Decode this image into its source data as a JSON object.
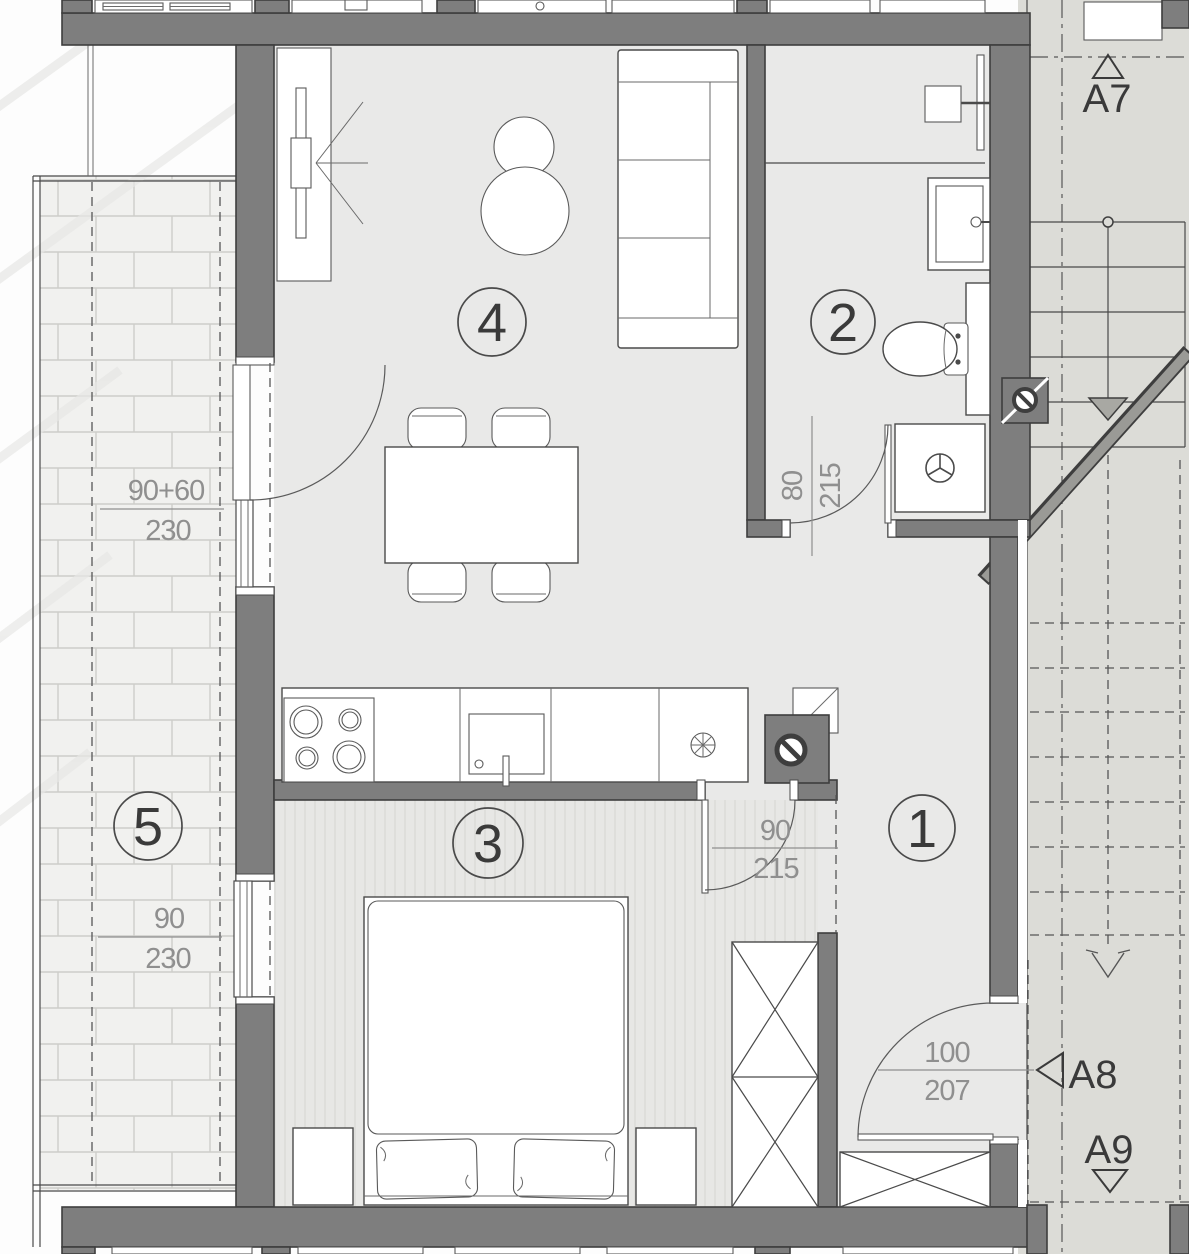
{
  "page": {
    "title": "Apartment floor plan with stairwell"
  },
  "rooms": [
    {
      "number": "1",
      "name": "hall"
    },
    {
      "number": "2",
      "name": "bathroom"
    },
    {
      "number": "3",
      "name": "bedroom"
    },
    {
      "number": "4",
      "name": "living-dining"
    },
    {
      "number": "5",
      "name": "balcony"
    }
  ],
  "dimensions": {
    "balcony_door": {
      "width": "90+60",
      "height": "230"
    },
    "balcony_window": {
      "width": "90",
      "height": "230"
    },
    "bathroom_door": {
      "width": "80",
      "height": "215"
    },
    "bedroom_door": {
      "width": "90",
      "height": "215"
    },
    "entry_door": {
      "width": "100",
      "height": "207"
    }
  },
  "stair_labels": {
    "a7": "A7",
    "a8": "A8",
    "a9": "A9"
  },
  "icons": [
    "stove-icon",
    "sink-icon",
    "extractor-fan-icon",
    "vent-shaft-icon",
    "shower-icon",
    "washbasin-icon",
    "toilet-icon",
    "washing-machine-icon",
    "sofa-icon",
    "tv-icon",
    "plant-icon",
    "dining-table-icon",
    "bed-icon",
    "wardrobe-icon",
    "stair-arrow-icon"
  ],
  "colors": {
    "wall": "#7e7e7e",
    "wall_outline": "#3e3e3e",
    "floor": "#e9e9e8",
    "balcony_floor": "#f1f1ef",
    "stair_floor": "#dcdcd7",
    "bedroom_floor": "#e7e7e5",
    "dim_text": "#8f8f8f",
    "label_text": "#3a3a3a"
  }
}
